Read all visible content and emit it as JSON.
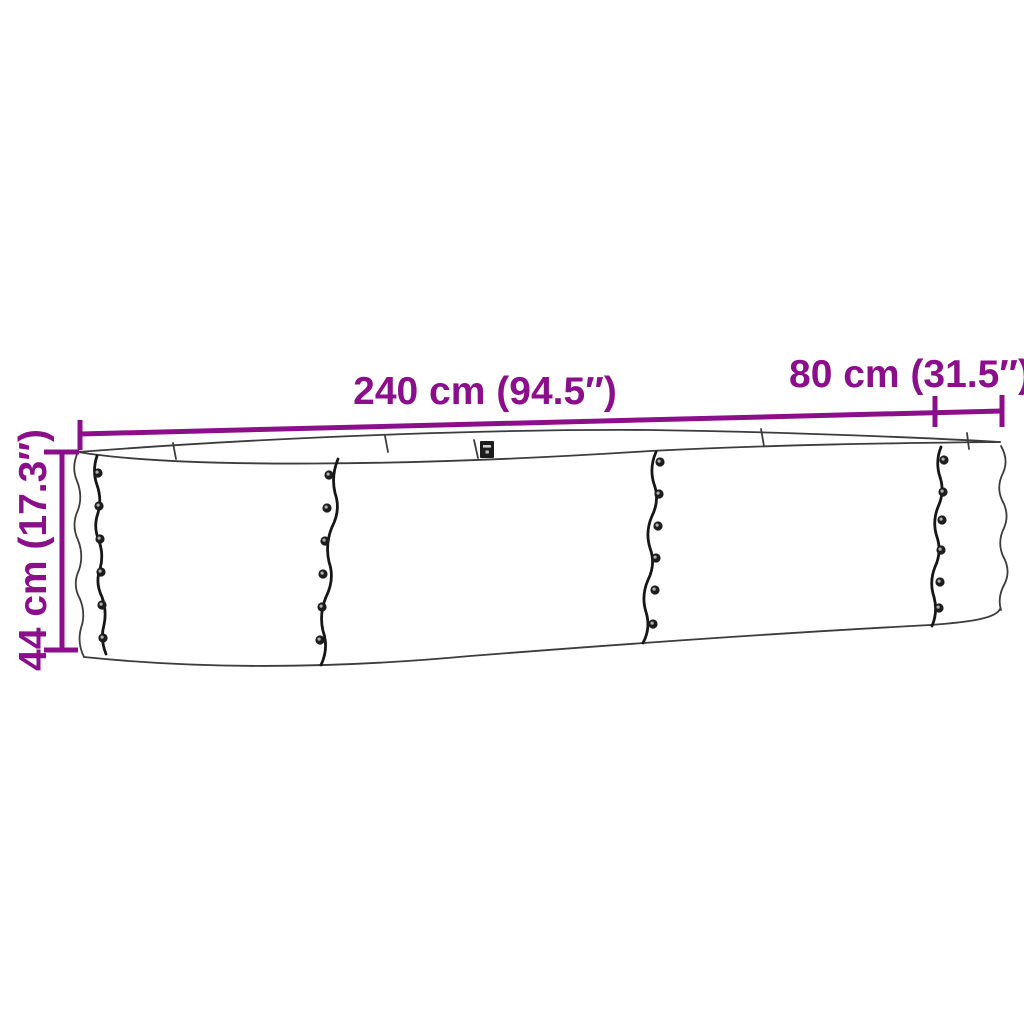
{
  "colors": {
    "background": "#ffffff",
    "accent": "#8B0F8B",
    "ink": "#3c3c3c",
    "ink_heavy": "#161616"
  },
  "labels": {
    "length": "240 cm (94.5″)",
    "width": "80 cm (31.5″)",
    "height": "44 cm (17.3″)"
  },
  "dimensions": {
    "length_cm": 240,
    "length_in": 94.5,
    "width_cm": 80,
    "width_in": 31.5,
    "height_cm": 44,
    "height_in": 17.3
  }
}
